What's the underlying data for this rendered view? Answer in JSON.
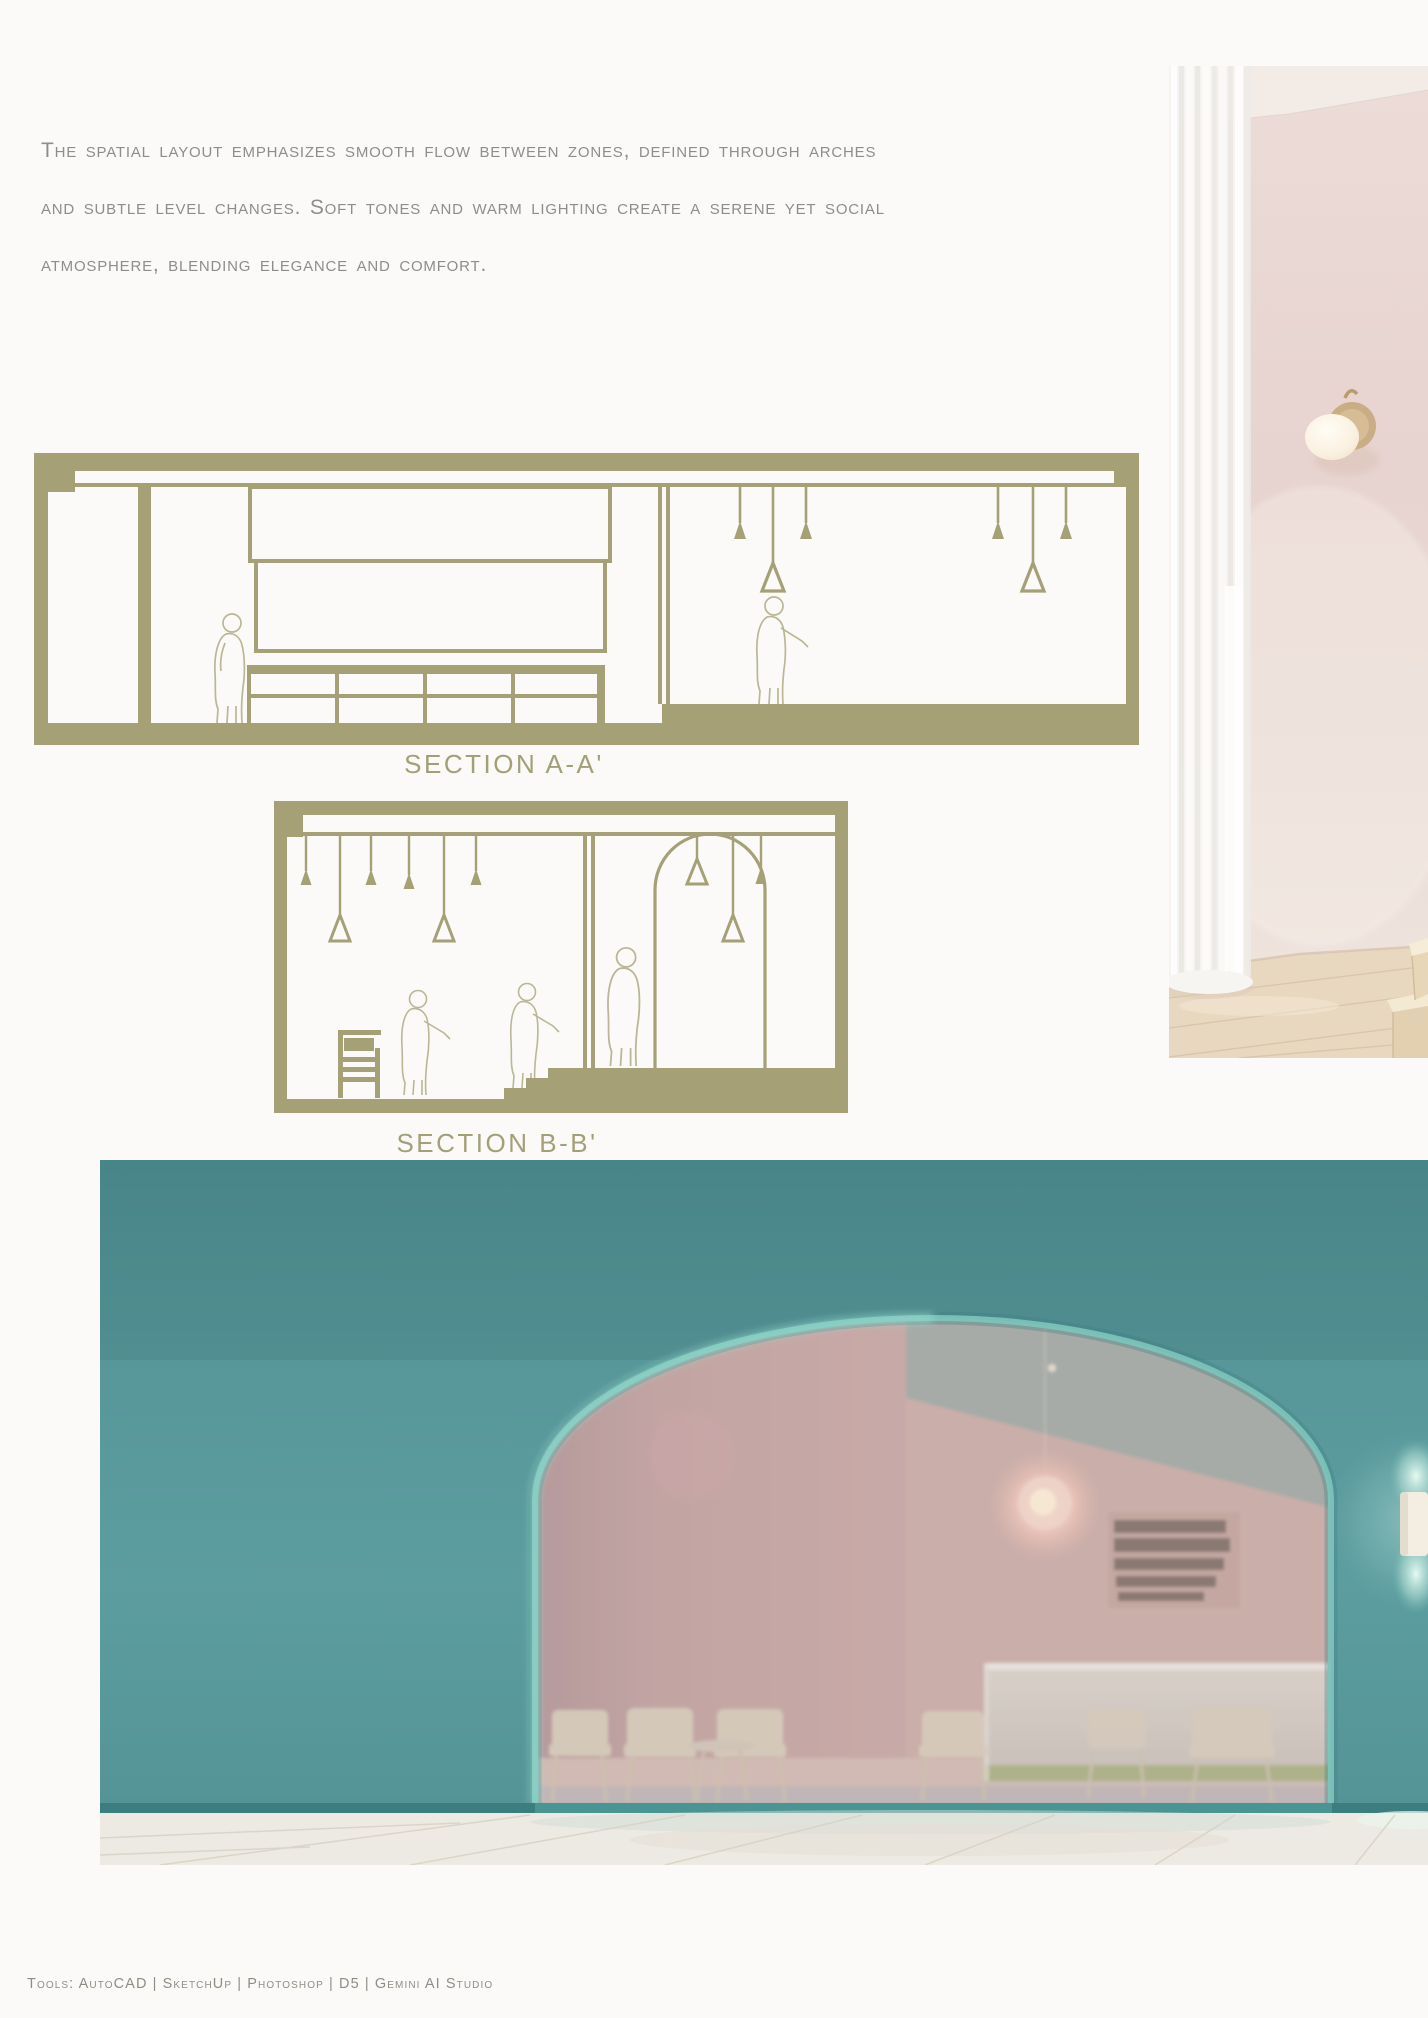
{
  "intro": {
    "lines": [
      "The spatial layout emphasizes smooth flow between zones, defined through arches",
      "and subtle level changes. Soft tones and warm lighting create a serene yet social",
      "atmosphere, blending elegance and comfort."
    ],
    "text_color": "#8e8d8a"
  },
  "sections": {
    "drawing_color": "#a5a076",
    "section_a": {
      "label": "SECTION A-A'"
    },
    "section_b": {
      "label": "SECTION B-B'"
    }
  },
  "photo_top_right": {
    "description": "Pink interior render with sheer white curtain, brass globe wall sconce and wooden steps",
    "wall_color": "#e9d7d3",
    "curtain_color": "#f7f5f2",
    "wood_color": "#e9d8c0"
  },
  "render_bottom": {
    "description": "Teal facade with large arched opening revealing a pink cafe interior with counter, chairs and pendant light",
    "teal_wall_color": "#58989b",
    "arch_rim_color": "#83ccc2",
    "interior_pink_color": "#c6aaa7",
    "counter_color": "#d5d1ca"
  },
  "footer": {
    "tools_line": "Tools: AutoCAD | SketchUp | Photoshop | D5 | Gemini AI Studio"
  }
}
